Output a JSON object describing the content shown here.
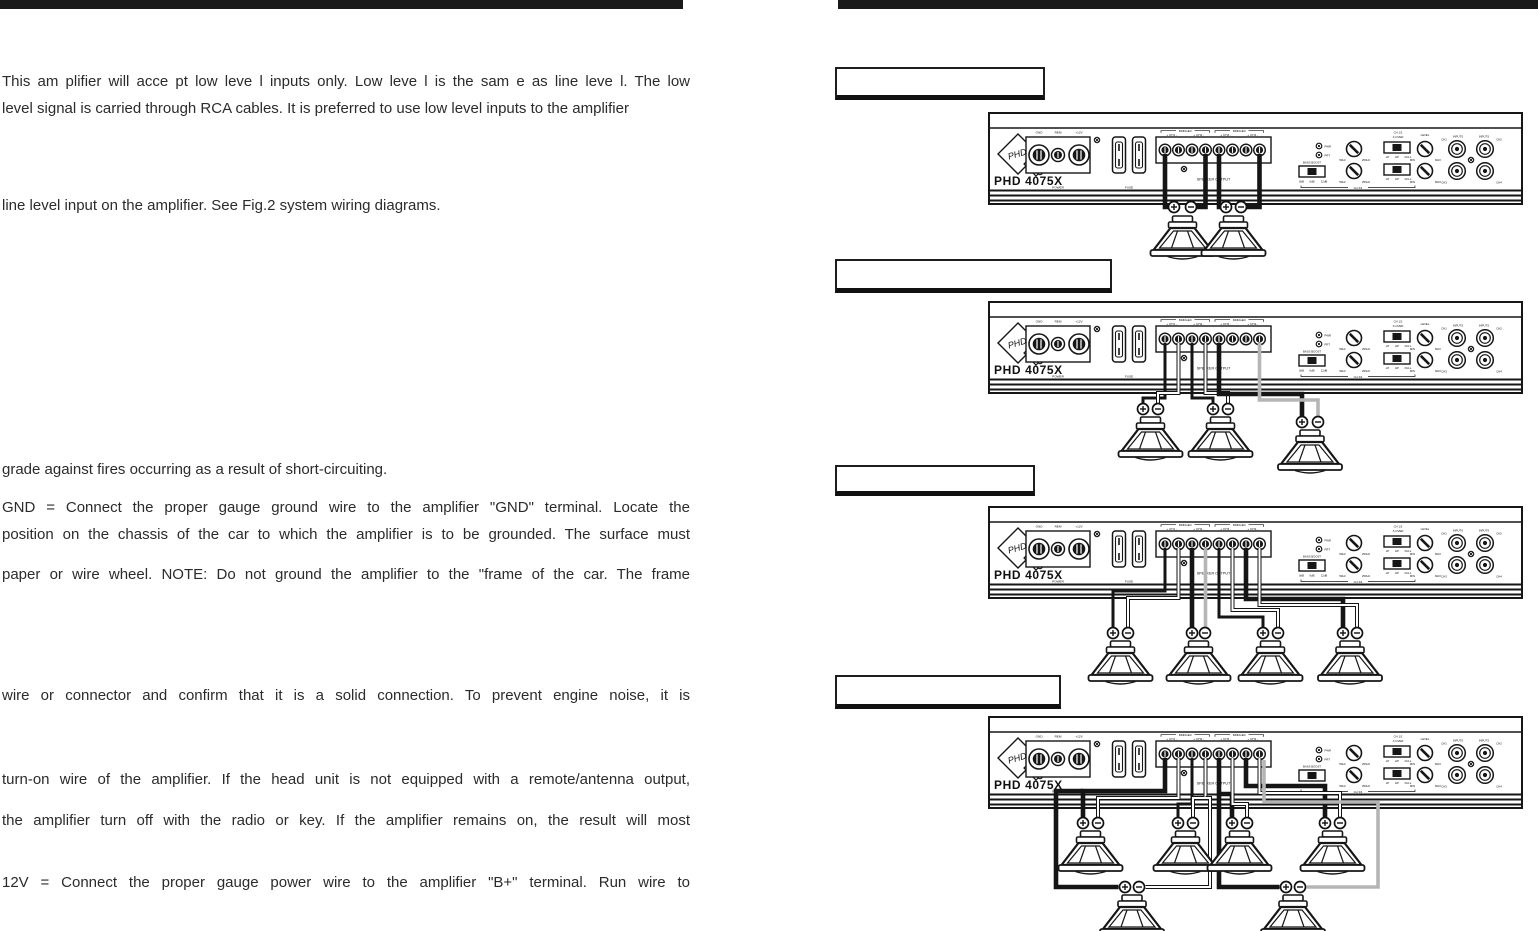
{
  "page": {
    "width": 1538,
    "height": 931,
    "background": "#ffffff",
    "bar_color": "#1a1a1a"
  },
  "left_column": {
    "lines": [
      {
        "text": "This am plifier will acce pt low leve l inputs only. Low leve l is the sam e as line leve l. The low"
      },
      {
        "text": "level signal is carried through RCA cables. It is preferred to use low level inputs to the amplifier"
      },
      {
        "text": "line level input on the amplifier. See Fig.2 system wiring diagrams."
      },
      {
        "text": "grade against  fires occurring as a result of short-circuiting."
      },
      {
        "text": "GND = Connect the proper gauge ground wire to the amplifier \"GND\" terminal. Locate the"
      },
      {
        "text": "position on the chassis of the car to which the amplifier is to be grounded. The surface must"
      },
      {
        "text": "paper or wire wheel. NOTE: Do not ground the amplifier to the \"frame of the car. The frame"
      },
      {
        "text": "wire or connector and confirm that it is a solid connection. To prevent engine noise, it is"
      },
      {
        "text": "turn-on wire of the amplifier. If the head unit is not equipped with a remote/antenna output,"
      },
      {
        "text": "the amplifier turn off with the radio or key. If the amplifier remains on, the result will most"
      },
      {
        "text": "12V = Connect the proper gauge power wire to the amplifier \"B+\" terminal. Run wire to"
      }
    ]
  },
  "amplifier": {
    "model": "PHD 4075X",
    "logo_text": "PHD",
    "power_section": {
      "terminals": [
        "GND",
        "REM",
        "+12V"
      ],
      "label": "POWER"
    },
    "fuse_label": "FUSE",
    "speaker_section": {
      "channels": [
        "+ CH1 -",
        "+ CH2 -",
        "+ CH3 -",
        "+ CH4 -"
      ],
      "bridged_left": "BRIDGED",
      "bridged_right": "BRIDGED",
      "label": "SPEAKER OUTPUT"
    },
    "controls": {
      "led_power": "PWR",
      "led_protect": "PRT",
      "bass_boost": "BASS BOOST",
      "boost_0": "0dB",
      "boost_6": "6dB",
      "boost_12": "12dB",
      "freq_lo": "50Hz",
      "freq_hi": "250Hz",
      "ch12": "CH 1/2",
      "xover": "X-OVER",
      "xo_lp": "LP",
      "xo_hp": "HP",
      "xo_full": "FULL",
      "ch34": "CH 3/4",
      "level": "LEVEL",
      "min": "MIN",
      "max": "MAX"
    },
    "inputs": {
      "label_left": "INPUTS",
      "label_right": "INPUTS",
      "ch1": "CH1",
      "ch2": "CH2",
      "ch3": "CH3",
      "ch4": "CH4"
    }
  },
  "figures": [
    {
      "caption": "",
      "speakers": 2
    },
    {
      "caption": "",
      "speakers": 3
    },
    {
      "caption": "",
      "speakers": 4
    },
    {
      "caption": "",
      "speakers": 6
    }
  ]
}
